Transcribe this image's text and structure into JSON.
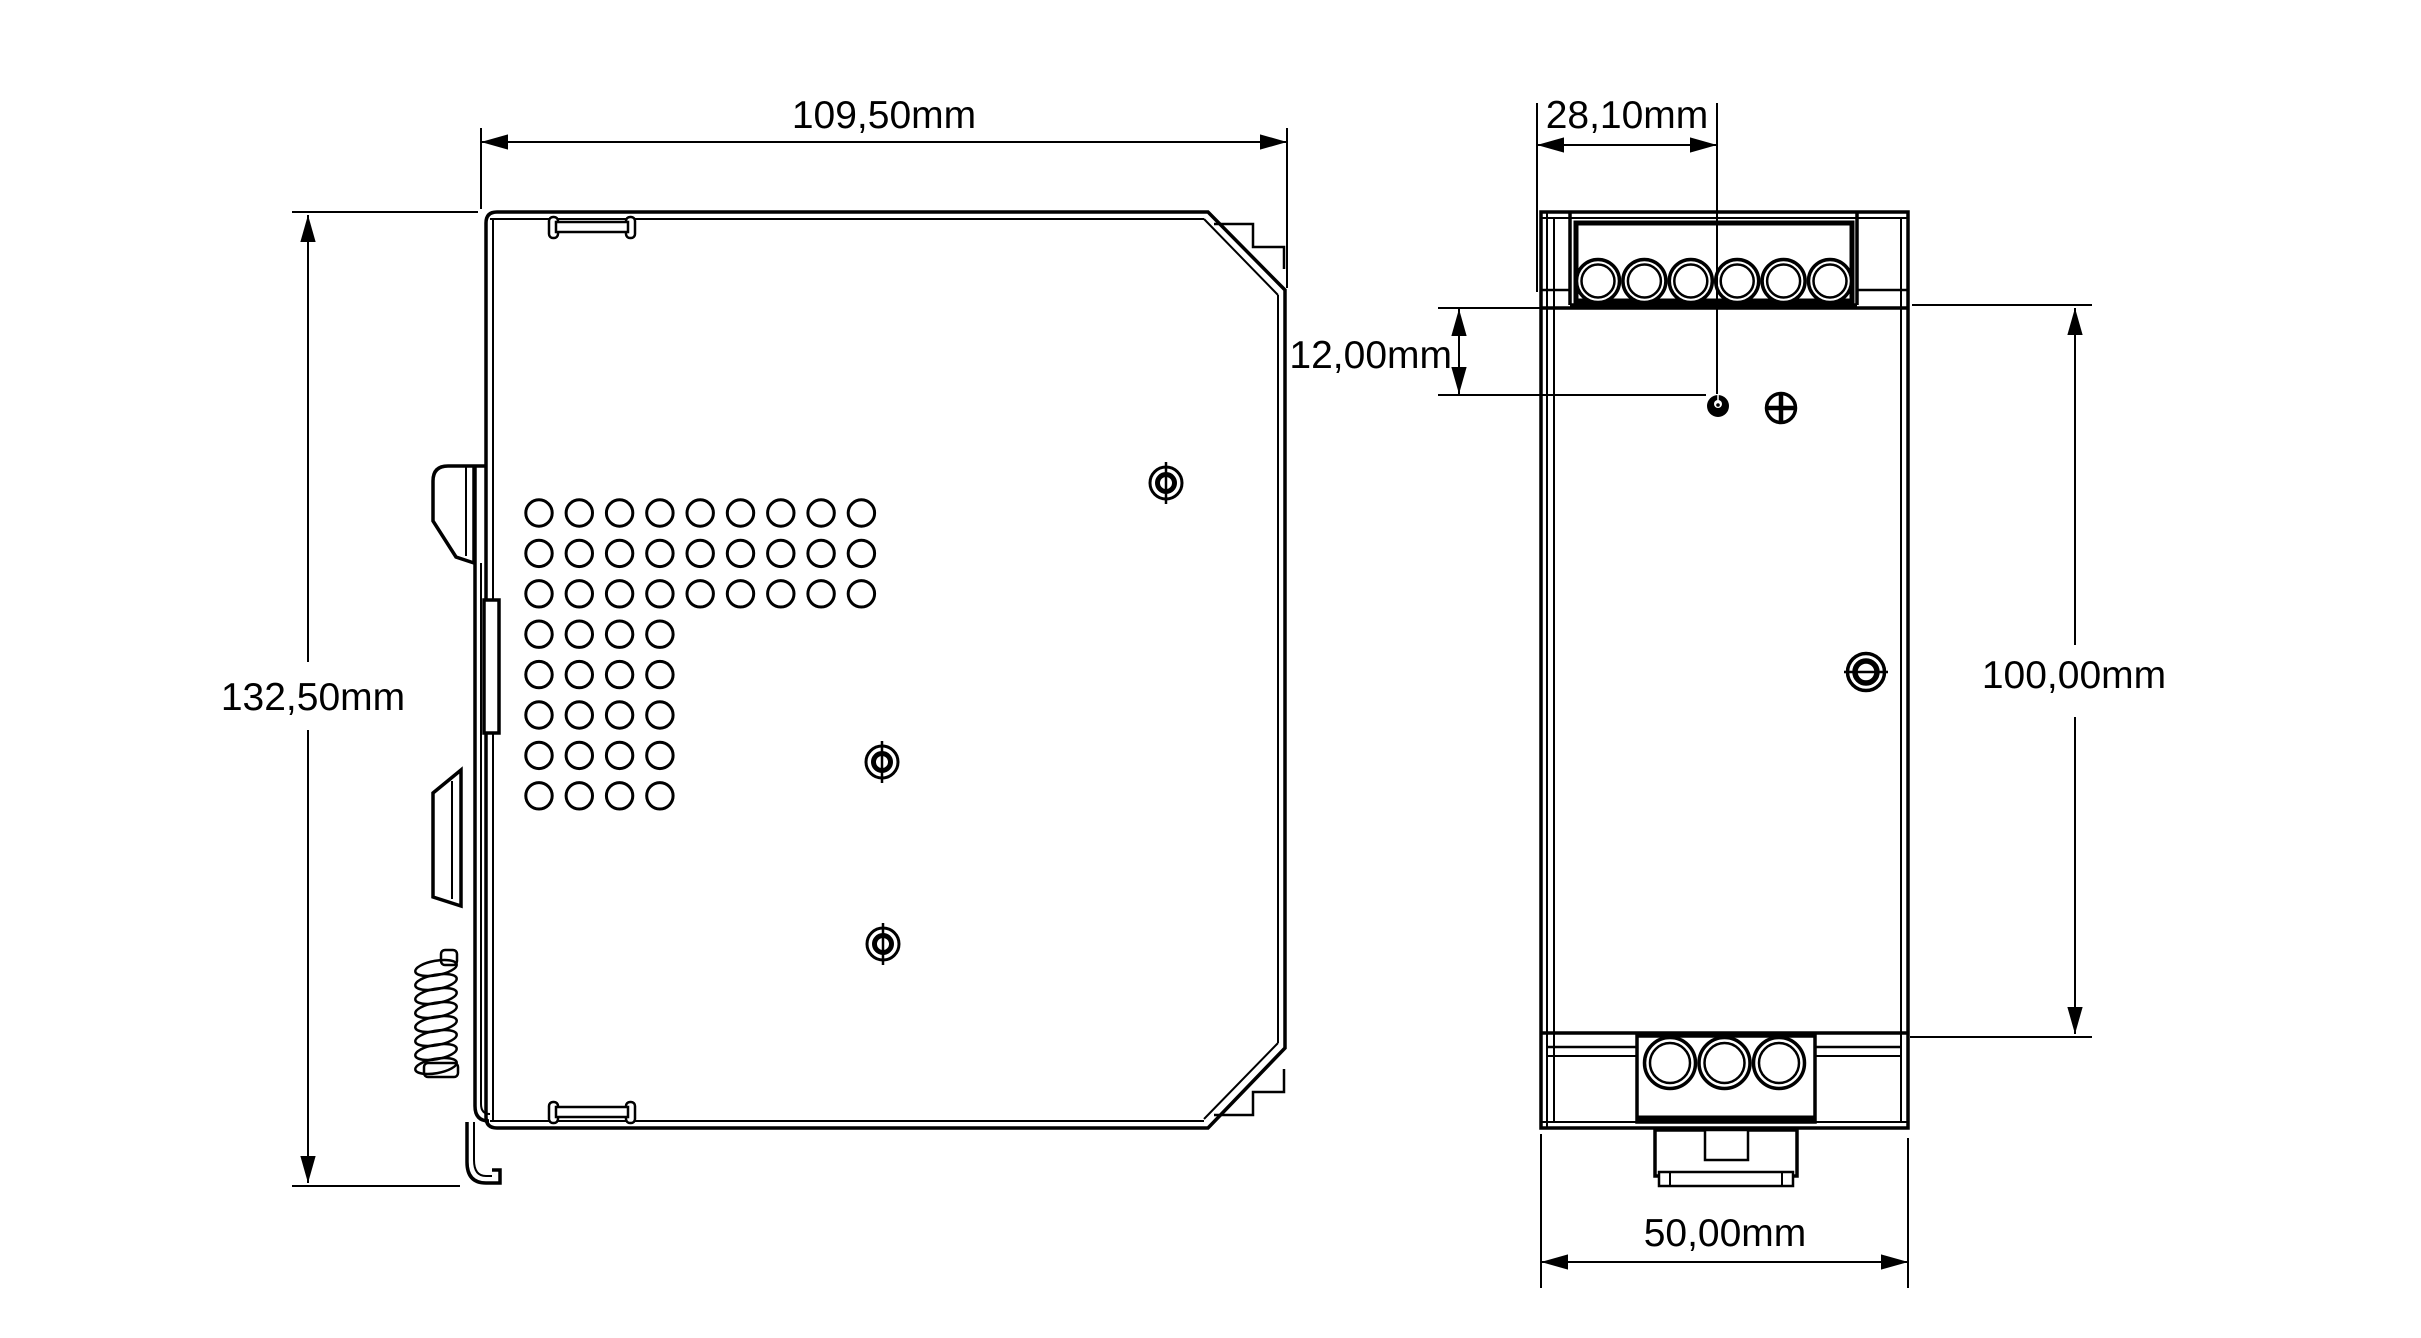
{
  "drawing": {
    "units": "mm",
    "background_color": "#ffffff",
    "line_color": "#000000",
    "side_view": {
      "name": "side-view",
      "width_label": "109,50mm",
      "height_label": "132,50mm",
      "vent_full_rows": 3,
      "vent_full_cols": 9,
      "vent_short_rows": 5,
      "vent_short_cols": 4,
      "screw_count": 3
    },
    "front_view": {
      "name": "front-view",
      "top_terminal_count": 6,
      "bottom_terminal_count": 3,
      "adjuster_offset_label": "28,10mm",
      "adjuster_drop_label": "12,00mm",
      "mounting_height_label": "100,00mm",
      "width_label": "50,00mm"
    }
  }
}
